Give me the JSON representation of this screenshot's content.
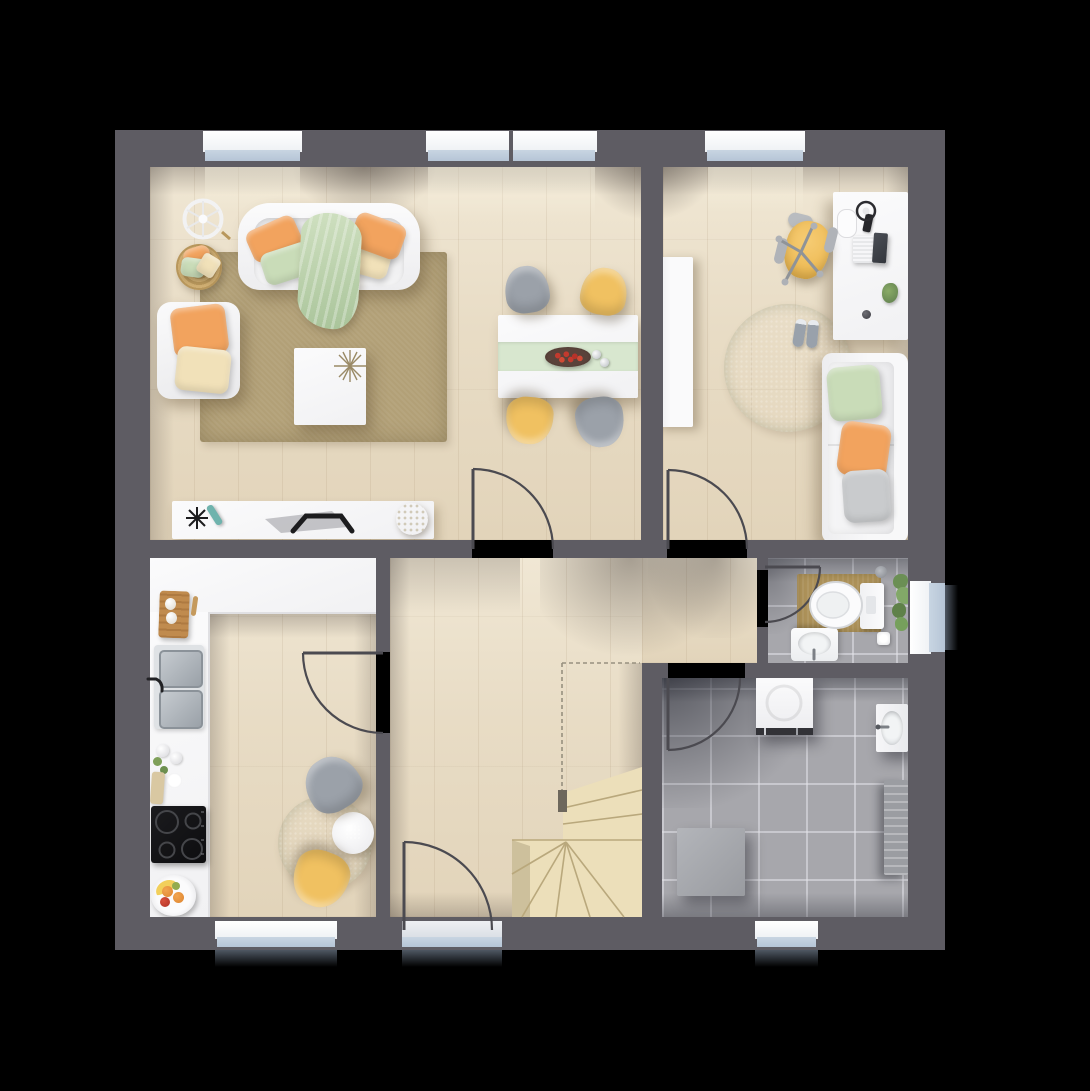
{
  "meta": {
    "title": "Ground-floor plan – furnished top-down 3D render",
    "visible_text": ""
  },
  "canvas": {
    "width": 1090,
    "height": 1091
  },
  "palette": {
    "background": "#000000",
    "wall": "#5e5c63",
    "wood": "#e8dcc5",
    "tile": "#a7a7ac",
    "stairs": "#ecdfba",
    "stair-line": "#b9a87c",
    "rug-tan": "#b2a077",
    "rug-green": "#a9c099",
    "white": "#f1f1f3",
    "orange": "#f2a35e",
    "mint": "#c9dcb8",
    "cream": "#f1e1b9",
    "chair-yellow": "#f0c161",
    "chair-gray": "#9ba1a9",
    "runner": "#d8e7cf",
    "glass": "#b6c5d6",
    "sill": "#eef1f4",
    "bath-mat": "#ac9159",
    "steel": "#b6bcc2",
    "appliance-dark": "#323237",
    "door-line": "#4b4a50",
    "dash-line": "#97907f"
  },
  "rooms": [
    {
      "id": "living-room",
      "label": "living room",
      "furniture": [
        "sofa",
        "throw-blanket",
        "armchair",
        "pillow-basket",
        "wheel-decor",
        "area-rug",
        "coffee-table",
        "tv-sideboard",
        "tv",
        "remote"
      ]
    },
    {
      "id": "dining-area",
      "label": "dining area",
      "furniture": [
        "dining-table",
        "table-runner",
        "fruit-bowl",
        "salt-pepper",
        "chair-gray-x2",
        "chair-yellow-x2"
      ]
    },
    {
      "id": "office",
      "label": "office / guest room",
      "furniture": [
        "wardrobe",
        "desk",
        "laptop",
        "headphones",
        "phone",
        "notepad",
        "desk-plant",
        "office-chair",
        "round-rug",
        "shoes",
        "daybed"
      ]
    },
    {
      "id": "kitchen",
      "label": "kitchen",
      "furniture": [
        "l-shaped-counter",
        "cutting-board",
        "double-sink",
        "faucet",
        "dish-set",
        "cooktop",
        "fruit-plate",
        "bistro-table",
        "table-plant",
        "chair-gray",
        "chair-yellow",
        "round-rug"
      ]
    },
    {
      "id": "hallway",
      "label": "hallway",
      "furniture": [
        "winder-staircase",
        "stair-opening-dashed-outline"
      ]
    },
    {
      "id": "bathroom",
      "label": "wc",
      "furniture": [
        "toilet",
        "cistern",
        "toilet-paper",
        "washbasin",
        "bath-mat",
        "shower-head",
        "window-plant"
      ]
    },
    {
      "id": "utility-room",
      "label": "utility room",
      "furniture": [
        "washing-machine",
        "wall-sink",
        "radiator",
        "appliance-box"
      ]
    }
  ],
  "openings": {
    "top_windows": 3,
    "bottom_windows": 2,
    "side_window_bathroom": 1,
    "entrance_door": 1,
    "interior_doors": [
      "living-dining",
      "office",
      "kitchen",
      "bathroom",
      "utility"
    ]
  }
}
